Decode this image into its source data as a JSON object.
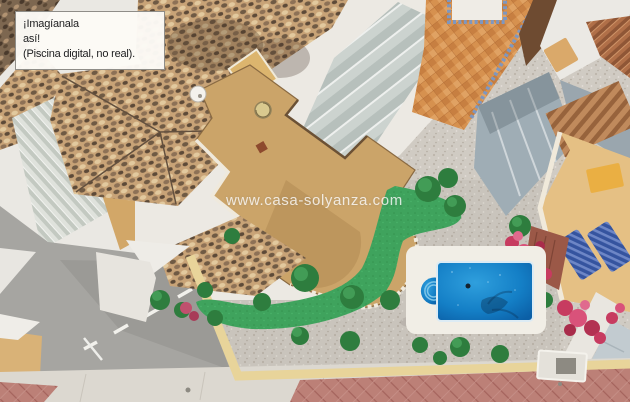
{
  "caption_box": {
    "line1": "¡Imagíanala",
    "line2": "así!",
    "line3": "(Piscina digital, no real)."
  },
  "watermark": {
    "text": "www.casa-solyanza.com"
  },
  "scene": {
    "description": "Aerial drone photo of a corner villa with sandy roof terraces and mottled tile roofs, a gravel garden crossed by green turf paths with shrubs and bougainvillea, a digitally added blue swimming pool with roman steps, neighbouring terracotta roofs, patios and sun loungers, and gray streets with sidewalks below.",
    "colors": {
      "pool_blue": "#147fc6",
      "turf_green": "#3fa35d",
      "terrace_tan": "#cba469",
      "roof_mottle_brown": "#8d7156",
      "gravel_gray": "#d0cbc3",
      "asphalt_gray": "#a6a5a1",
      "paving_red": "#bc8077",
      "bougainvillea_pink": "#c73b60",
      "patio_orange": "#d6914f",
      "caption_background": "#fcfaf6",
      "watermark_color": "#ffffff"
    }
  }
}
